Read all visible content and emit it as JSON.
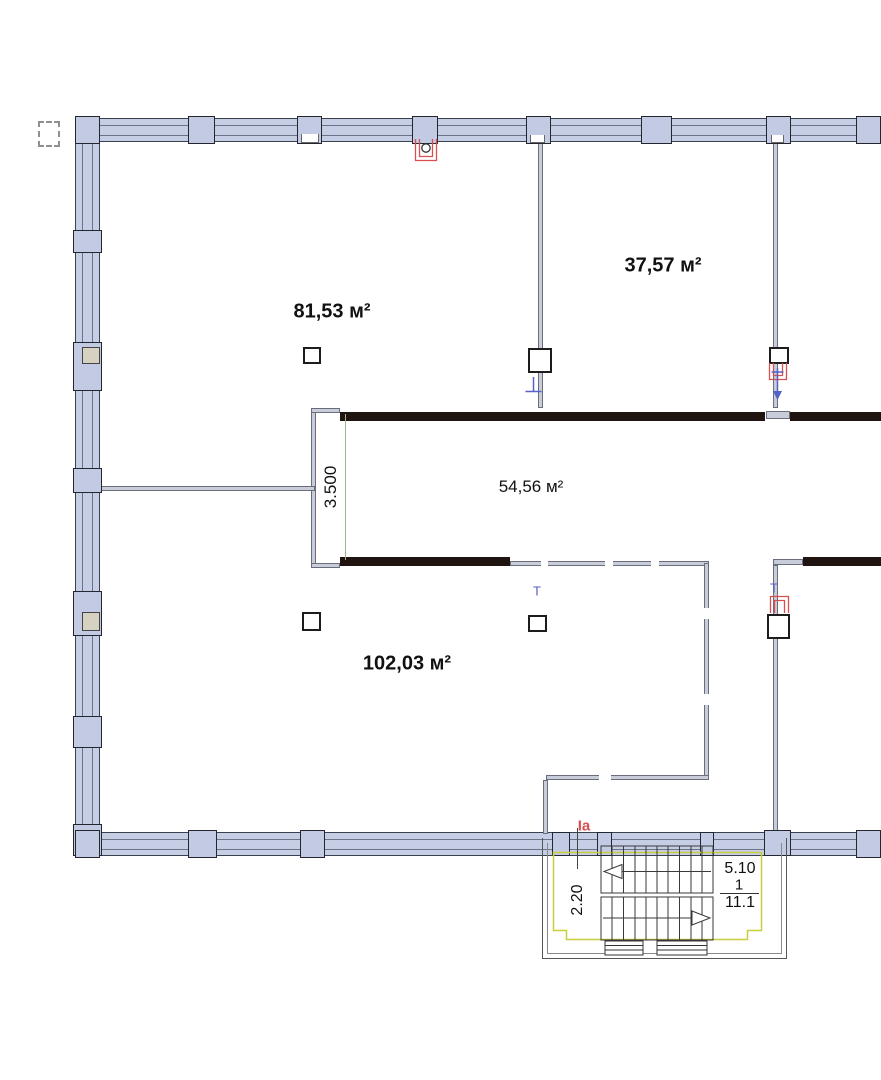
{
  "plan": {
    "rooms": [
      {
        "id": "room-top-left",
        "area": "81,53 м²"
      },
      {
        "id": "room-top-right",
        "area": "37,57 м²"
      },
      {
        "id": "corridor",
        "area": "54,56 м²"
      },
      {
        "id": "room-bottom-left",
        "area": "102,03 м²"
      }
    ],
    "dimensions": {
      "corridor_depth": "3.500",
      "stair_width": "2.20",
      "stair_top": "5.10",
      "stair_mid": "1",
      "stair_bottom": "11.1"
    },
    "marks": {
      "section": "Ia",
      "tee_1": "T",
      "tee_2": "T"
    },
    "colors": {
      "wall_fill": "#c6cee5",
      "wall_outline": "#3b404e",
      "dark_wall": "#1f1410",
      "partition": "#c9cdd9",
      "stair_outline_yellow": "#c9ce3f",
      "grid_line_green": "#9cb886",
      "annotation_red": "#d94f4f",
      "annotation_blue": "#5560c8"
    }
  }
}
